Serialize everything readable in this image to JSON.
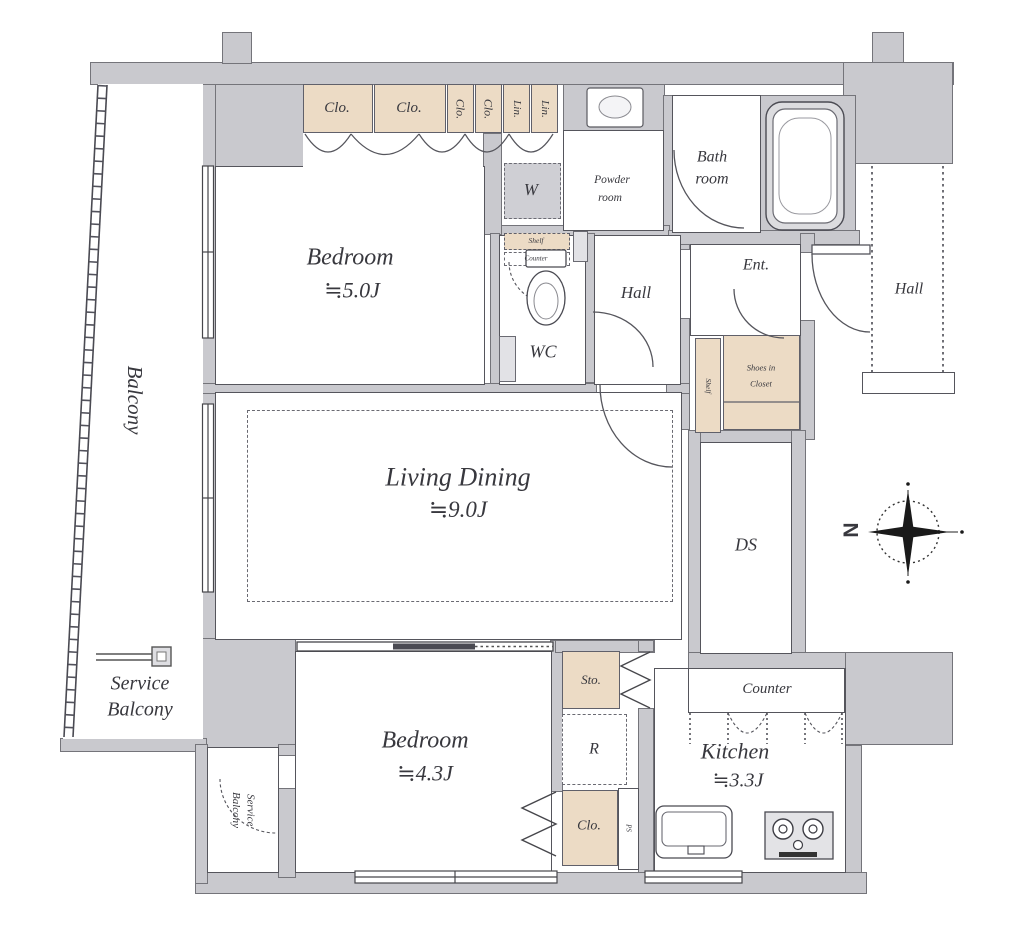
{
  "document_type": "apartment floor plan",
  "colors": {
    "wall_fill": "#c9c9ce",
    "closet_fill": "#ecdbc5",
    "line": "#55555c",
    "label_text": "#38383e",
    "room_fill": "#ffffff"
  },
  "labels": {
    "balcony": "Balcony",
    "service_line1": "Service",
    "service_line2": "Balcony",
    "bedroom": "Bedroom",
    "bedroom_top_area": "≒5.0J",
    "bedroom_bottom_area": "≒4.3J",
    "living": "Living Dining",
    "living_area": "≒9.0J",
    "kitchen": "Kitchen",
    "kitchen_area": "≒3.3J",
    "counter": "Counter",
    "bath_line1": "Bath",
    "bath_line2": "room",
    "powder_line1": "Powder",
    "powder_line2": "room",
    "wc": "WC",
    "hall": "Hall",
    "ent": "Ent.",
    "ds": "DS",
    "sto": "Sto.",
    "fridge": "R",
    "clo": "Clo.",
    "lin": "Lin.",
    "washer": "W",
    "shoes_line1": "Shoes in",
    "shoes_line2": "Closet",
    "shelf": "Shelf",
    "wc_counter": "Counter",
    "ps": "PS",
    "north": "N"
  },
  "icons": {
    "compass": "compass-rose-north-left",
    "bathtub": "bathtub",
    "toilet": "toilet",
    "powder_sink": "wash-basin",
    "kitchen_sink": "kitchen-sink",
    "stove": "two-burner-stove",
    "faucet": "balcony-faucet"
  }
}
